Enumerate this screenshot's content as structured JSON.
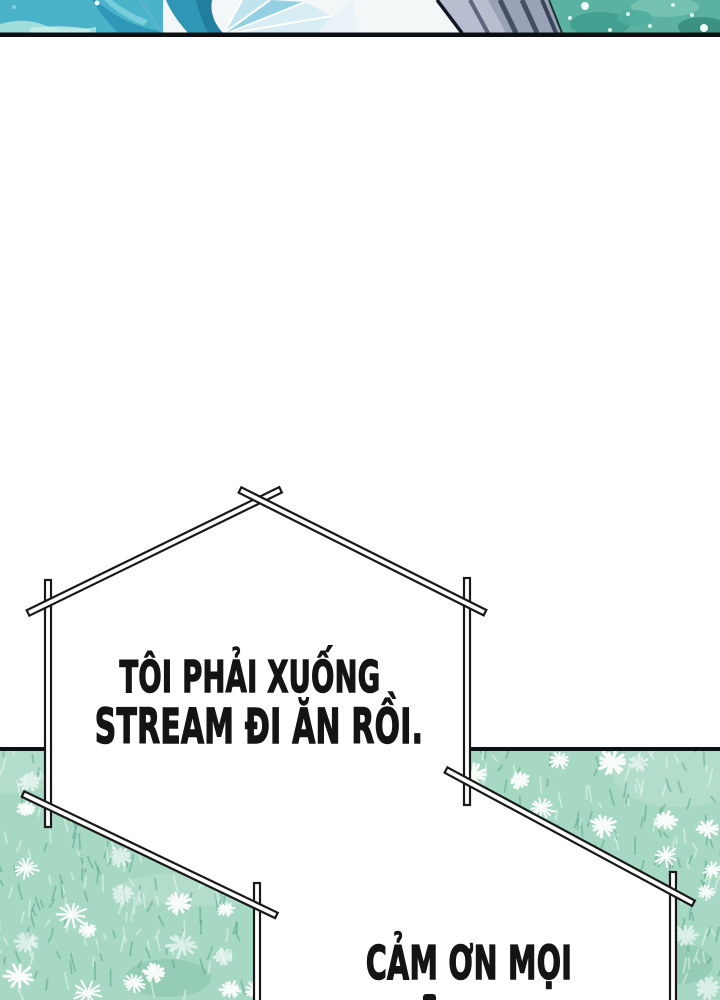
{
  "comic": {
    "bubble1": {
      "lines": [
        "TÔI PHẢI XUỐNG",
        "STREAM ĐI ĂN RỒI."
      ]
    },
    "bubble2": {
      "lines": [
        "CẢM ƠN MỌI"
      ]
    }
  },
  "colors": {
    "field_base": "#a6d8c3",
    "grass_dark": "rgba(72,152,124,0.42)",
    "grass_light": "rgba(236,252,244,0.5)",
    "flower_white": "#fdfffd",
    "panel_border": "#0d1115",
    "bubble_outline": "#191919",
    "bubble_fill": "#ffffff",
    "text_color": "#141414",
    "strip_teal": "#4ab3ca",
    "strip_gray": "#99a2b6",
    "strip_foliage": "#5bb1a2"
  }
}
